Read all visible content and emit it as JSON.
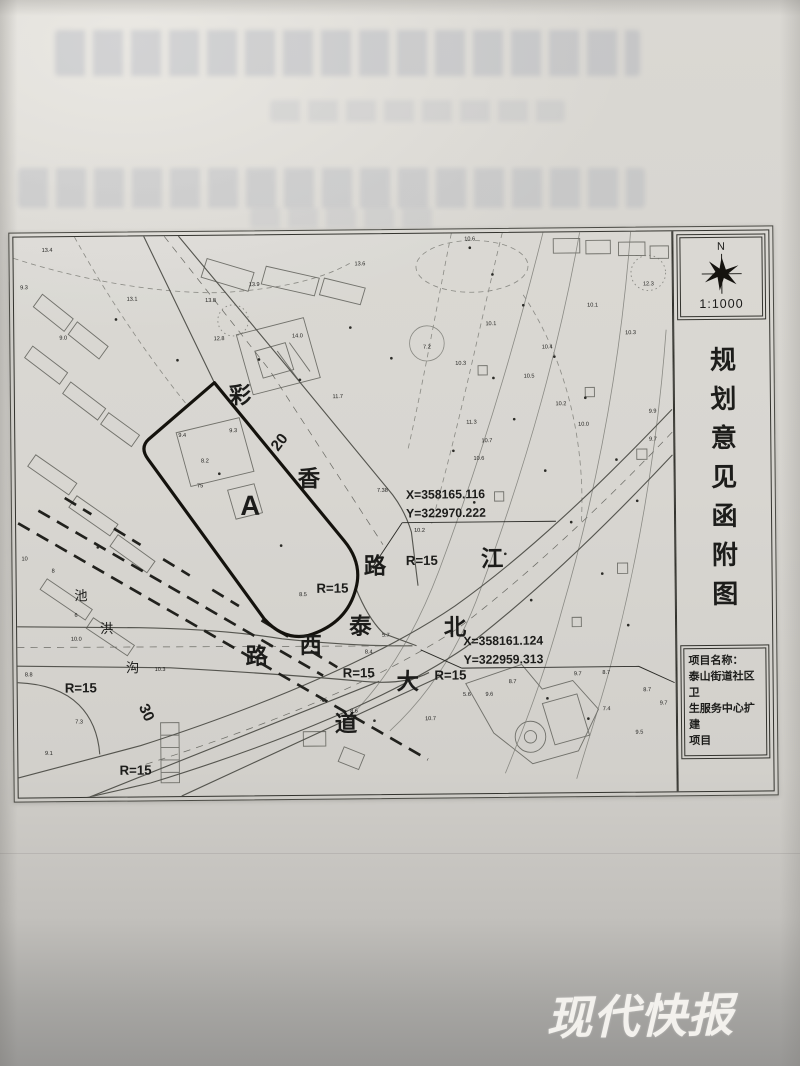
{
  "panel": {
    "north_label": "N",
    "scale": "1:1000",
    "title": "规划意见函附图",
    "project": {
      "heading": "项目名称：",
      "line1": "泰山街道社区卫",
      "line2": "生服务中心扩建",
      "line3": "项目"
    }
  },
  "watermark": {
    "text": "现代快报",
    "color": "#f3f1ed"
  },
  "map": {
    "site_label": "A",
    "labels": [
      {
        "t": "彩",
        "x": 221,
        "y": 162,
        "s": 22,
        "w": "bold"
      },
      {
        "t": "香",
        "x": 288,
        "y": 243,
        "s": 22,
        "w": "bold"
      },
      {
        "t": "路",
        "x": 352,
        "y": 328,
        "s": 22,
        "w": "bold"
      },
      {
        "t": "泰",
        "x": 337,
        "y": 386,
        "s": 22,
        "w": "bold"
      },
      {
        "t": "西",
        "x": 288,
        "y": 404,
        "s": 22,
        "w": "bold"
      },
      {
        "t": "路",
        "x": 235,
        "y": 414,
        "s": 22,
        "w": "bold"
      },
      {
        "t": "江",
        "x": 467,
        "y": 322,
        "s": 22,
        "w": "bold"
      },
      {
        "t": "北",
        "x": 430,
        "y": 388,
        "s": 22,
        "w": "bold"
      },
      {
        "t": "大",
        "x": 383,
        "y": 440,
        "s": 22,
        "w": "bold"
      },
      {
        "t": "道",
        "x": 322,
        "y": 480,
        "s": 22,
        "w": "bold"
      },
      {
        "t": "A",
        "x": 230,
        "y": 270,
        "s": 27,
        "w": "bold"
      },
      {
        "t": "池",
        "x": 63,
        "y": 351,
        "s": 13
      },
      {
        "t": "洪",
        "x": 88,
        "y": 383,
        "s": 13
      },
      {
        "t": "沟",
        "x": 113,
        "y": 421,
        "s": 13
      },
      {
        "t": "R=15",
        "x": 310,
        "y": 346,
        "s": 13,
        "w": "bold"
      },
      {
        "t": "R=15",
        "x": 398,
        "y": 320,
        "s": 13,
        "w": "bold"
      },
      {
        "t": "R=15",
        "x": 335,
        "y": 428,
        "s": 13,
        "w": "bold"
      },
      {
        "t": "R=15",
        "x": 425,
        "y": 431,
        "s": 13,
        "w": "bold"
      },
      {
        "t": "R=15",
        "x": 62,
        "y": 440,
        "s": 13,
        "w": "bold"
      },
      {
        "t": "R=15",
        "x": 115,
        "y": 520,
        "s": 13,
        "w": "bold"
      },
      {
        "t": "20",
        "x": 263,
        "y": 203,
        "s": 15,
        "w": "bold",
        "r": -52
      },
      {
        "t": "30",
        "x": 122,
        "y": 462,
        "s": 15,
        "w": "bold",
        "r": 66
      },
      {
        "t": "X=358165.116",
        "x": 383,
        "y": 256,
        "s": 12,
        "w": "bold",
        "a": "s"
      },
      {
        "t": "Y=322970.222",
        "x": 383,
        "y": 274,
        "s": 12,
        "w": "bold",
        "a": "s"
      },
      {
        "t": "X=358161.124",
        "x": 438,
        "y": 398,
        "s": 12,
        "w": "bold",
        "a": "s"
      },
      {
        "t": "Y=322959.313",
        "x": 438,
        "y": 416,
        "s": 12,
        "w": "bold",
        "a": "s"
      }
    ],
    "heights": [
      {
        "t": "13.4",
        "x": 33,
        "y": 14
      },
      {
        "t": "13.1",
        "x": 116,
        "y": 62
      },
      {
        "t": "13.8",
        "x": 193,
        "y": 64
      },
      {
        "t": "13.9",
        "x": 236,
        "y": 49
      },
      {
        "t": "14.0",
        "x": 278,
        "y": 99
      },
      {
        "t": "12.8",
        "x": 201,
        "y": 101
      },
      {
        "t": "13.6",
        "x": 340,
        "y": 30
      },
      {
        "t": "11.7",
        "x": 317,
        "y": 158
      },
      {
        "t": "10.6",
        "x": 448,
        "y": 7
      },
      {
        "t": "7.2",
        "x": 405,
        "y": 111
      },
      {
        "t": "10.1",
        "x": 468,
        "y": 89
      },
      {
        "t": "10.4",
        "x": 523,
        "y": 112
      },
      {
        "t": "10.3",
        "x": 605,
        "y": 99
      },
      {
        "t": "10.3",
        "x": 438,
        "y": 127
      },
      {
        "t": "10.2",
        "x": 536,
        "y": 167
      },
      {
        "t": "10.1",
        "x": 568,
        "y": 72
      },
      {
        "t": "12.3",
        "x": 623,
        "y": 52
      },
      {
        "t": "11.3",
        "x": 448,
        "y": 184
      },
      {
        "t": "10.7",
        "x": 463,
        "y": 202
      },
      {
        "t": "10.6",
        "x": 455,
        "y": 219
      },
      {
        "t": "10.0",
        "x": 558,
        "y": 187
      },
      {
        "t": "9.7",
        "x": 626,
        "y": 202
      },
      {
        "t": "9.9",
        "x": 626,
        "y": 175
      },
      {
        "t": "8.7",
        "x": 486,
        "y": 435
      },
      {
        "t": "9.7",
        "x": 550,
        "y": 428
      },
      {
        "t": "8.7",
        "x": 578,
        "y": 427
      },
      {
        "t": "8.7",
        "x": 618,
        "y": 444
      },
      {
        "t": "9.7",
        "x": 634,
        "y": 457
      },
      {
        "t": "9.6",
        "x": 463,
        "y": 447
      },
      {
        "t": "5.6",
        "x": 441,
        "y": 447
      },
      {
        "t": "7.4",
        "x": 578,
        "y": 462
      },
      {
        "t": "9.5",
        "x": 610,
        "y": 485
      },
      {
        "t": "10.7",
        "x": 405,
        "y": 470
      },
      {
        "t": "75",
        "x": 181,
        "y": 243
      },
      {
        "t": "9.4",
        "x": 164,
        "y": 194
      },
      {
        "t": "9.3",
        "x": 214,
        "y": 190
      },
      {
        "t": "8.2",
        "x": 186,
        "y": 219
      },
      {
        "t": "7.38",
        "x": 360,
        "y": 249
      },
      {
        "t": "8.5",
        "x": 281,
        "y": 349
      },
      {
        "t": "5.7",
        "x": 362,
        "y": 389
      },
      {
        "t": "8.4",
        "x": 345,
        "y": 405
      },
      {
        "t": "10",
        "x": 8,
        "y": 312
      },
      {
        "t": "8",
        "x": 36,
        "y": 324
      },
      {
        "t": "6",
        "x": 58,
        "y": 367
      },
      {
        "t": "8.8",
        "x": 11,
        "y": 424
      },
      {
        "t": "10.0",
        "x": 58,
        "y": 390
      },
      {
        "t": "9.3",
        "x": 10,
        "y": 50
      },
      {
        "t": "9.0",
        "x": 48,
        "y": 99
      },
      {
        "t": "10.3",
        "x": 140,
        "y": 420
      },
      {
        "t": "7.3",
        "x": 60,
        "y": 470
      },
      {
        "t": "9.1",
        "x": 30,
        "y": 500
      },
      {
        "t": "8.6",
        "x": 330,
        "y": 462
      },
      {
        "t": "10.2",
        "x": 396,
        "y": 288
      },
      {
        "t": "10.5",
        "x": 505,
        "y": 140
      }
    ]
  }
}
